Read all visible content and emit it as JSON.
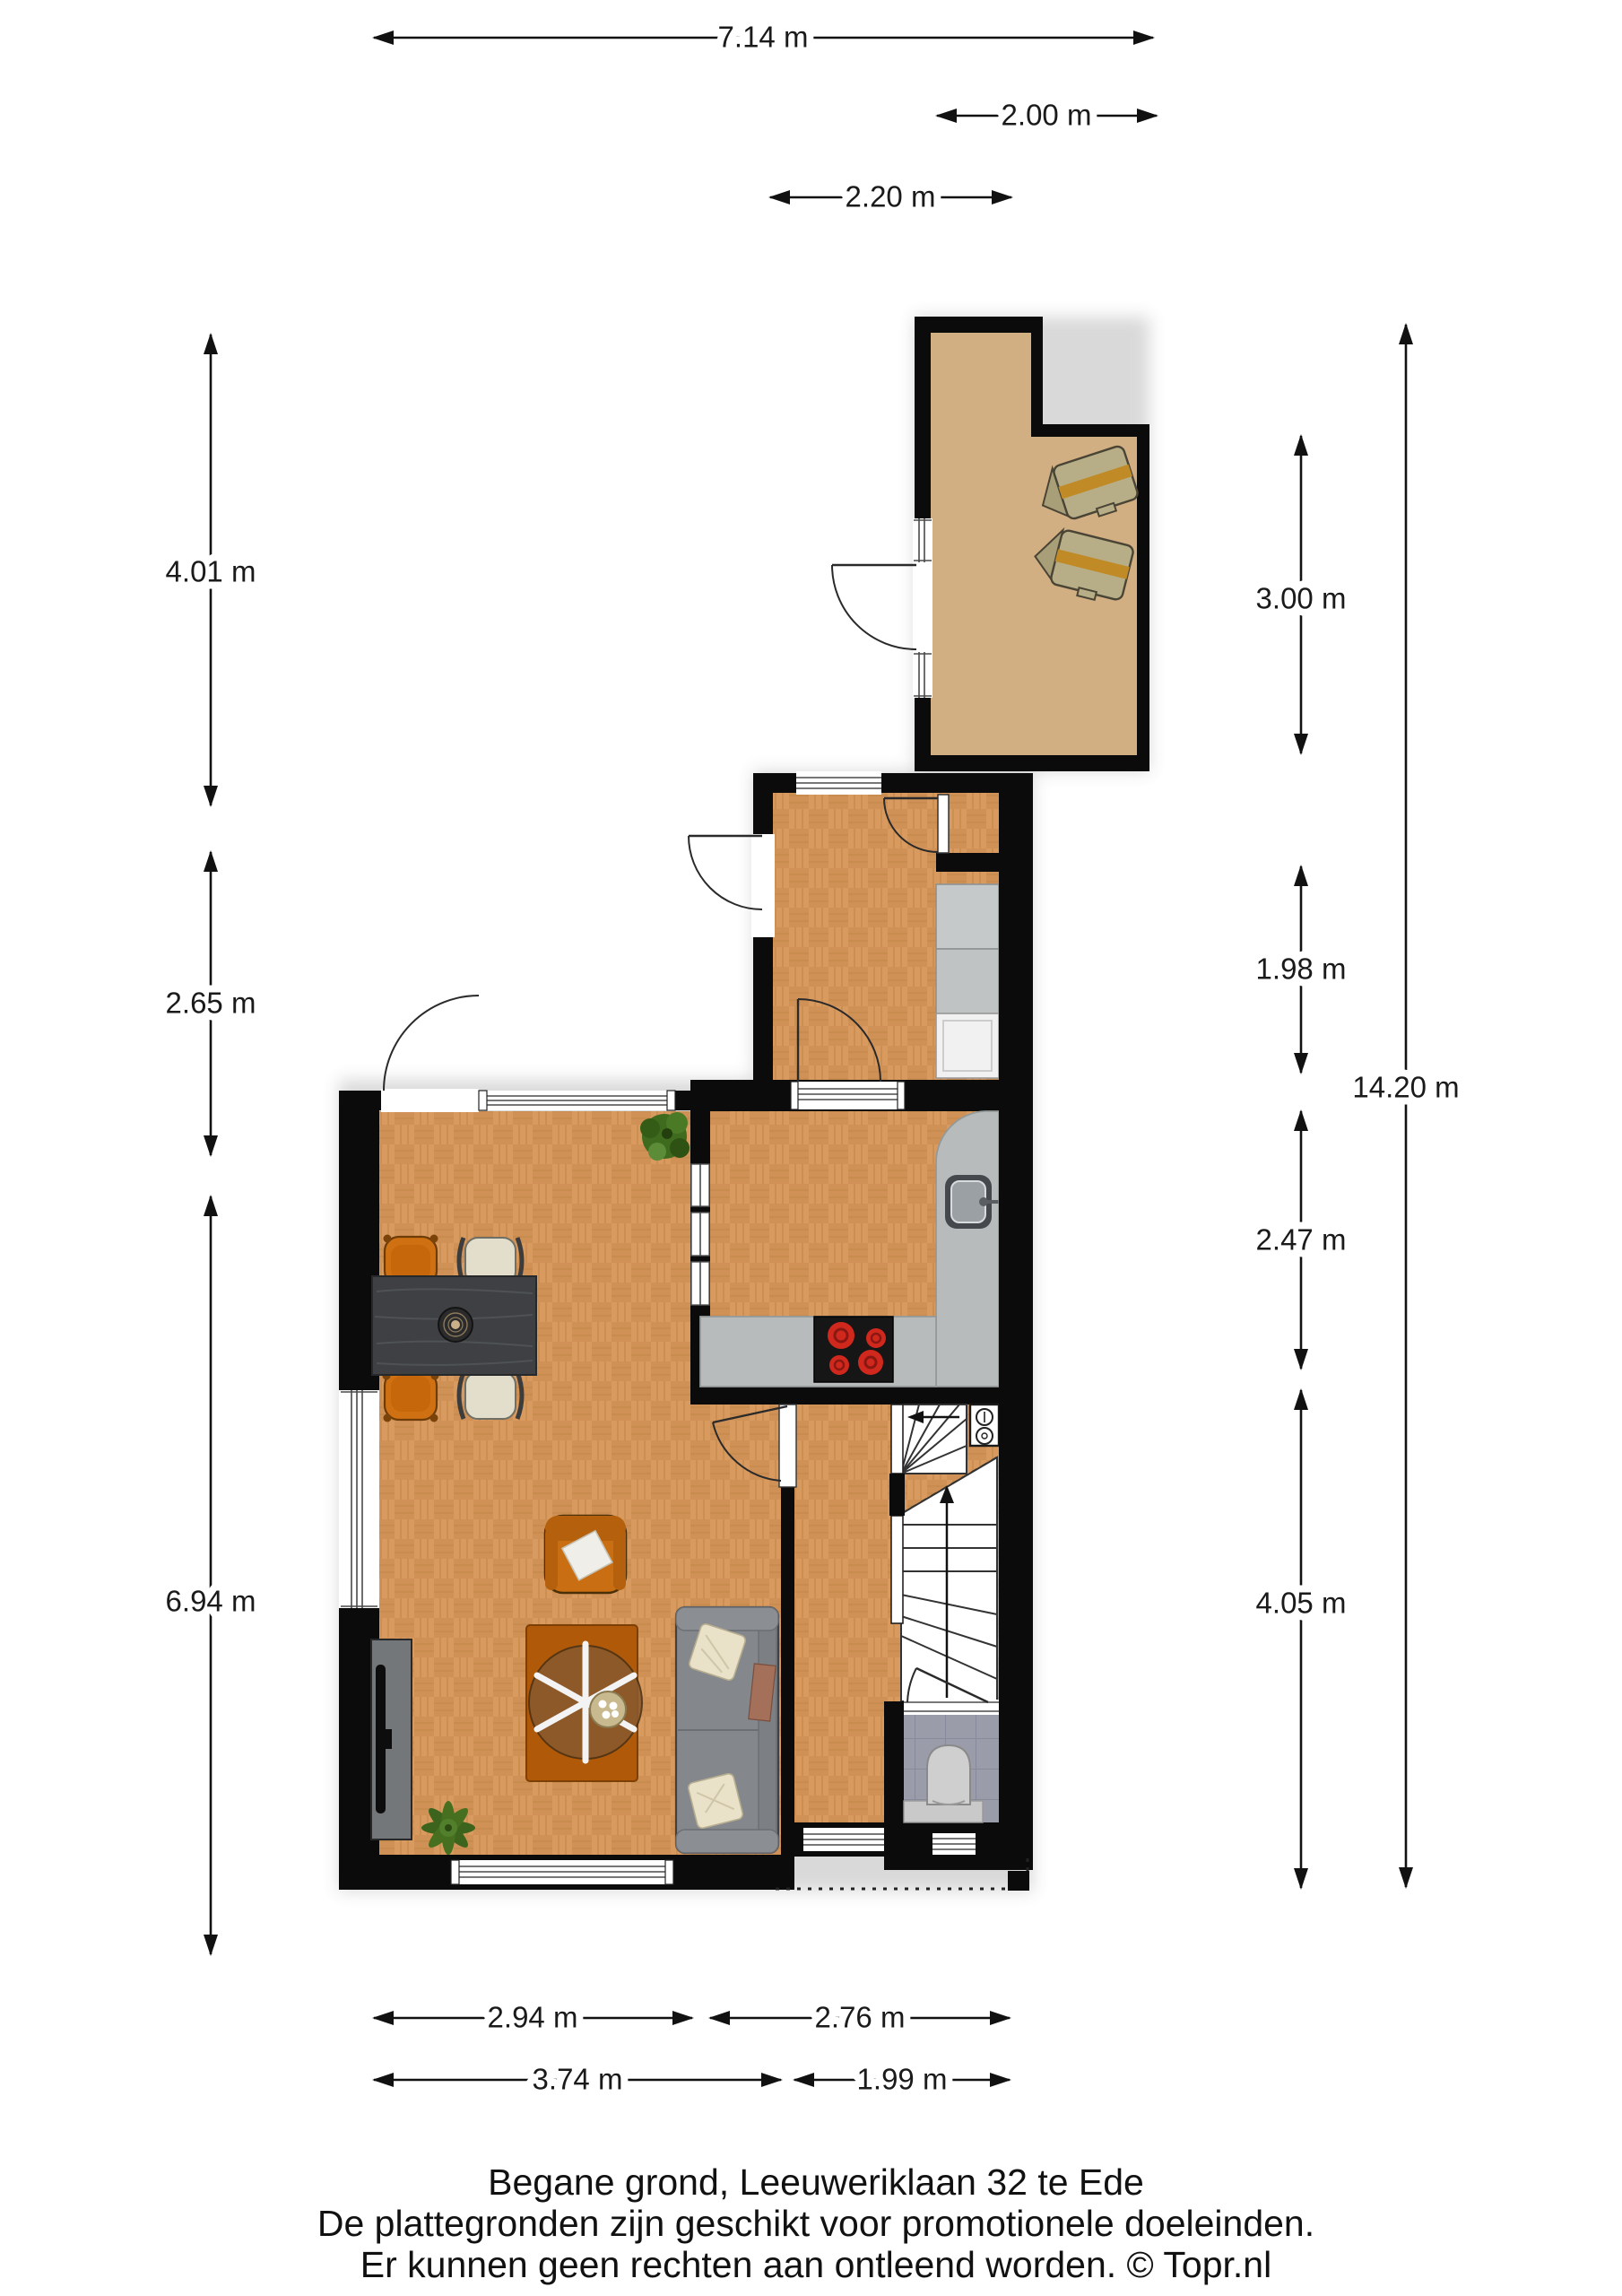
{
  "title_block": {
    "line1": "Begane grond, Leeuweriklaan 32 te Ede",
    "line2": "De plattegronden zijn geschikt voor promotionele doeleinden.",
    "line3": "Er kunnen geen rechten aan ontleend worden. © Topr.nl"
  },
  "dimensions": {
    "top": {
      "total_width": "7.14 m",
      "storage_width": "2.00 m",
      "utility_width": "2.20 m"
    },
    "left": {
      "upper": "4.01 m",
      "middle": "2.65 m",
      "living": "6.94 m"
    },
    "right": {
      "storage": "3.00 m",
      "utility": "1.98 m",
      "kitchen": "2.47 m",
      "hall": "4.05 m",
      "total_height": "14.20 m"
    },
    "bottom": {
      "living_inner": "2.94 m",
      "kitchen_inner": "2.76 m",
      "living_outer": "3.74 m",
      "hall_outer": "1.99 m"
    }
  },
  "colors": {
    "wall": "#0b0b0b",
    "wood_floor": "#d79a5e",
    "storage_floor": "#d2af83",
    "toilet_tile": "#9a9caa",
    "counter_gray": "#b7bbbb",
    "burner_red": "#d0281c",
    "chair_orange": "#cf7112",
    "sofa_gray": "#84878c"
  },
  "rooms": [
    "storage-room",
    "utility-room",
    "kitchen",
    "living-room",
    "hallway",
    "toilet"
  ],
  "furniture": [
    "stacked-chairs",
    "washer-dryer-column",
    "kitchen-counter",
    "sink",
    "stove",
    "dining-table",
    "dining-chairs",
    "plant",
    "armchair",
    "rug",
    "coffee-table",
    "sofa",
    "tv-sideboard",
    "stairs",
    "meter-cupboard",
    "toilet-bowl"
  ]
}
